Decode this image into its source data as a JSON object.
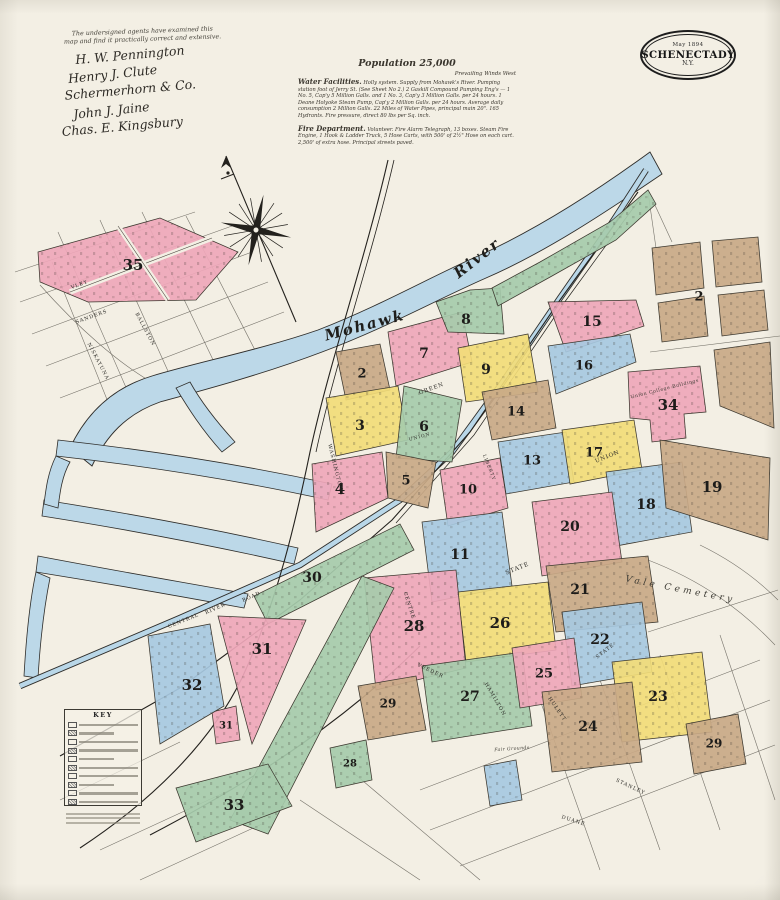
{
  "badge": {
    "date": "May 1894",
    "city": "SCHENECTADY",
    "state": "N.Y."
  },
  "certification": {
    "note_line1": "The undersigned agents have examined this",
    "note_line2": "map and find it practically correct and extensive.",
    "signatures": [
      "H. W. Pennington",
      "Henry J. Clute",
      "Schermerhorn & Co.",
      "John J. Jaine",
      "Chas. E. Kingsbury"
    ]
  },
  "statistics": {
    "population": "Population 25,000",
    "winds": "Prevailing Winds West",
    "water_heading": "Water Facilities.",
    "water_text": "Holly system. Supply from Mohawk's River. Pumping station foot of Jerry St. (See Sheet No 2.) 2 Gaskill Compound Pumping Eng's — 1 No. 5, Cap'y 5 Million Galls. and 1 No. 3, Cap'y 3 Million Galls. per 24 hours. 1 Deane Holyoke Steam Pump, Cap'y 2 Million Galls. per 24 hours. Average daily consumption 2 Million Galls. 22 Miles of Water Pipes, principal main 20\". 165 Hydrants. Fire pressure, direct 80 lbs per Sq. inch.",
    "fire_heading": "Fire Department.",
    "fire_text": "Volunteer. Fire Alarm Telegraph, 13 boxes. Steam Fire Engine, 1 Hook & Ladder Truck, 5 Hose Carts, with 500' of 2½\" Hose on each cart. 2,500' of extra hose. Principal streets paved."
  },
  "key": {
    "title": "KEY"
  },
  "colors": {
    "pink": "#efa7ba",
    "yellow": "#f2dc78",
    "blue": "#a7c9e1",
    "green": "#a6cbab",
    "tan": "#c9a987",
    "river": "#bcd8e8",
    "ink": "#1d1c1a",
    "street": "#44413a"
  },
  "map": {
    "river_labels": [
      {
        "t": "Mohawk",
        "x": 366,
        "y": 330,
        "r": -15,
        "s": 15
      },
      {
        "t": "River",
        "x": 480,
        "y": 262,
        "r": -38,
        "s": 15
      }
    ],
    "area_labels": [
      {
        "t": "Vale Cemetery",
        "x": 680,
        "y": 592,
        "r": 11,
        "s": 9,
        "ls": 3.5,
        "it": true
      },
      {
        "t": "Union College Buildings",
        "x": 665,
        "y": 390,
        "r": -14,
        "s": 4.6,
        "ls": 0.6,
        "it": false
      },
      {
        "t": "Fair Grounds",
        "x": 512,
        "y": 750,
        "r": -4,
        "s": 4.6,
        "ls": 0.4,
        "it": true
      }
    ],
    "street_labels": [
      {
        "t": "SANDERS",
        "x": 92,
        "y": 318,
        "r": -20,
        "s": 5
      },
      {
        "t": "VLEY",
        "x": 80,
        "y": 286,
        "r": -20,
        "s": 5
      },
      {
        "t": "BALLSTON",
        "x": 144,
        "y": 330,
        "r": 62,
        "s": 5
      },
      {
        "t": "NISKAYUNA",
        "x": 97,
        "y": 362,
        "r": 62,
        "s": 5
      },
      {
        "t": "GREEN",
        "x": 432,
        "y": 390,
        "r": -20,
        "s": 5.5
      },
      {
        "t": "UNION",
        "x": 608,
        "y": 458,
        "r": -22,
        "s": 5.5
      },
      {
        "t": "UNION",
        "x": 420,
        "y": 438,
        "r": -15,
        "s": 4.5
      },
      {
        "t": "STATE",
        "x": 518,
        "y": 570,
        "r": -22,
        "s": 6
      },
      {
        "t": "STATE",
        "x": 606,
        "y": 652,
        "r": -38,
        "s": 5
      },
      {
        "t": "CENTRE",
        "x": 408,
        "y": 606,
        "r": 72,
        "s": 5
      },
      {
        "t": "VEEDER",
        "x": 430,
        "y": 672,
        "r": 25,
        "s": 5
      },
      {
        "t": "HAMILTON",
        "x": 494,
        "y": 700,
        "r": 60,
        "s": 5
      },
      {
        "t": "RIVER",
        "x": 216,
        "y": 610,
        "r": -24,
        "s": 5
      },
      {
        "t": "ROAD",
        "x": 252,
        "y": 598,
        "r": -24,
        "s": 5
      },
      {
        "t": "CENTRAL",
        "x": 184,
        "y": 622,
        "r": -22,
        "s": 5
      },
      {
        "t": "WASHINGTON",
        "x": 334,
        "y": 468,
        "r": 76,
        "s": 5
      },
      {
        "t": "LIBERTY",
        "x": 488,
        "y": 468,
        "r": 68,
        "s": 4.5
      },
      {
        "t": "HULETT",
        "x": 556,
        "y": 710,
        "r": 55,
        "s": 5
      },
      {
        "t": "STANLEY",
        "x": 630,
        "y": 788,
        "r": 25,
        "s": 5
      },
      {
        "t": "DUANE",
        "x": 573,
        "y": 822,
        "r": 18,
        "s": 5
      }
    ],
    "blocks": [
      {
        "n": "35",
        "c": "pink",
        "p": "38,252 160,218 238,252 196,300 88,302 40,282",
        "lx": 133,
        "ly": 266,
        "fs": 15
      },
      {
        "n": "2",
        "c": "tan",
        "p": "336,352 380,344 390,390 346,400",
        "lx": 362,
        "ly": 374,
        "fs": 13
      },
      {
        "n": "7",
        "c": "pink",
        "p": "388,332 462,312 472,362 396,386",
        "lx": 424,
        "ly": 354,
        "fs": 14
      },
      {
        "n": "8",
        "c": "green",
        "p": "436,302 470,290 500,288 504,334 448,332",
        "lx": 466,
        "ly": 320,
        "fs": 14
      },
      {
        "n": "",
        "c": "green",
        "p": "492,288 540,262 610,222 648,190 656,204 616,240 552,276 498,306"
      },
      {
        "n": "9",
        "c": "yellow",
        "p": "458,348 528,334 538,392 466,402",
        "lx": 486,
        "ly": 370,
        "fs": 14
      },
      {
        "n": "15",
        "c": "pink",
        "p": "548,302 636,300 644,326 566,352",
        "lx": 592,
        "ly": 322,
        "fs": 14
      },
      {
        "n": "16",
        "c": "blue",
        "p": "548,346 630,334 636,362 556,394",
        "lx": 584,
        "ly": 366,
        "fs": 13
      },
      {
        "n": "34",
        "c": "pink",
        "p": "628,372 700,366 706,412 684,414 686,438 652,442 650,420 630,418",
        "lx": 668,
        "ly": 406,
        "fs": 15
      },
      {
        "n": "",
        "c": "tan",
        "p": "652,248 700,242 704,288 656,295"
      },
      {
        "n": "",
        "c": "tan",
        "p": "712,241 758,237 762,282 716,287"
      },
      {
        "n": "",
        "c": "tan",
        "p": "658,303 704,296 708,336 662,342"
      },
      {
        "n": "",
        "c": "tan",
        "p": "718,295 764,290 768,330 722,336"
      },
      {
        "n": "2",
        "c": "",
        "p": "",
        "lx": 699,
        "ly": 297,
        "fs": 13
      },
      {
        "n": "",
        "c": "tan",
        "p": "714,350 770,342 774,428 720,406"
      },
      {
        "n": "3",
        "c": "yellow",
        "p": "326,398 398,386 408,440 336,456",
        "lx": 360,
        "ly": 426,
        "fs": 14
      },
      {
        "n": "6",
        "c": "green",
        "p": "404,386 462,400 452,462 396,458",
        "lx": 424,
        "ly": 427,
        "fs": 14
      },
      {
        "n": "14",
        "c": "tan",
        "p": "482,392 548,380 556,428 492,440",
        "lx": 516,
        "ly": 412,
        "fs": 13
      },
      {
        "n": "13",
        "c": "blue",
        "p": "498,442 566,432 574,482 506,494",
        "lx": 532,
        "ly": 461,
        "fs": 13
      },
      {
        "n": "17",
        "c": "yellow",
        "p": "562,430 634,420 642,470 570,484",
        "lx": 594,
        "ly": 453,
        "fs": 13
      },
      {
        "n": "4",
        "c": "pink",
        "p": "312,464 382,452 388,498 316,532",
        "lx": 340,
        "ly": 490,
        "fs": 15
      },
      {
        "n": "5",
        "c": "tan",
        "p": "386,452 436,462 428,508 388,498",
        "lx": 406,
        "ly": 481,
        "fs": 13
      },
      {
        "n": "10",
        "c": "pink",
        "p": "440,470 500,458 508,508 448,526",
        "lx": 468,
        "ly": 490,
        "fs": 13
      },
      {
        "n": "18",
        "c": "blue",
        "p": "606,472 682,462 692,532 616,546",
        "lx": 646,
        "ly": 505,
        "fs": 14
      },
      {
        "n": "19",
        "c": "tan",
        "p": "660,440 770,458 768,540 666,508",
        "lx": 712,
        "ly": 488,
        "fs": 15
      },
      {
        "n": "20",
        "c": "pink",
        "p": "532,502 612,492 622,562 542,576",
        "lx": 570,
        "ly": 527,
        "fs": 14
      },
      {
        "n": "11",
        "c": "blue",
        "p": "422,522 502,512 512,586 432,602",
        "lx": 460,
        "ly": 555,
        "fs": 14
      },
      {
        "n": "21",
        "c": "tan",
        "p": "546,566 648,556 658,622 556,632",
        "lx": 580,
        "ly": 590,
        "fs": 14
      },
      {
        "n": "26",
        "c": "yellow",
        "p": "458,592 548,582 556,650 466,662",
        "lx": 500,
        "ly": 624,
        "fs": 15
      },
      {
        "n": "28",
        "c": "pink",
        "p": "364,578 456,570 466,668 376,690",
        "lx": 414,
        "ly": 627,
        "fs": 15
      },
      {
        "n": "22",
        "c": "blue",
        "p": "562,612 642,602 652,672 572,686",
        "lx": 600,
        "ly": 640,
        "fs": 14
      },
      {
        "n": "27",
        "c": "green",
        "p": "422,666 522,652 532,726 432,742",
        "lx": 470,
        "ly": 697,
        "fs": 14
      },
      {
        "n": "25",
        "c": "pink",
        "p": "512,648 574,638 582,698 520,708",
        "lx": 544,
        "ly": 674,
        "fs": 13
      },
      {
        "n": "23",
        "c": "yellow",
        "p": "612,662 702,652 712,732 622,742",
        "lx": 658,
        "ly": 697,
        "fs": 14
      },
      {
        "n": "24",
        "c": "tan",
        "p": "542,692 632,682 642,762 552,772",
        "lx": 588,
        "ly": 727,
        "fs": 14
      },
      {
        "n": "29",
        "c": "tan",
        "p": "358,686 416,676 426,730 368,740",
        "lx": 388,
        "ly": 704,
        "fs": 12
      },
      {
        "n": "29",
        "c": "tan",
        "p": "686,724 738,714 746,764 694,774",
        "lx": 714,
        "ly": 744,
        "fs": 12
      },
      {
        "n": "30",
        "c": "green",
        "p": "254,596 400,524 414,550 268,624",
        "lx": 312,
        "ly": 578,
        "fs": 14
      },
      {
        "n": "31",
        "c": "pink",
        "p": "218,616 306,620 252,744",
        "lx": 262,
        "ly": 650,
        "fs": 15
      },
      {
        "n": "31",
        "c": "pink",
        "p": "212,712 236,706 240,740 216,744",
        "lx": 226,
        "ly": 726,
        "fs": 10
      },
      {
        "n": "32",
        "c": "blue",
        "p": "148,636 210,624 224,706 160,744",
        "lx": 192,
        "ly": 686,
        "fs": 15
      },
      {
        "n": "",
        "c": "green",
        "p": "362,576 394,588 268,834 230,820"
      },
      {
        "n": "33",
        "c": "green",
        "p": "176,788 268,764 292,806 196,842",
        "lx": 234,
        "ly": 806,
        "fs": 15
      },
      {
        "n": "28",
        "c": "green",
        "p": "330,748 366,740 372,780 336,788",
        "lx": 350,
        "ly": 764,
        "fs": 10
      },
      {
        "n": "",
        "c": "blue",
        "p": "484,766 516,760 522,800 490,806"
      }
    ]
  }
}
